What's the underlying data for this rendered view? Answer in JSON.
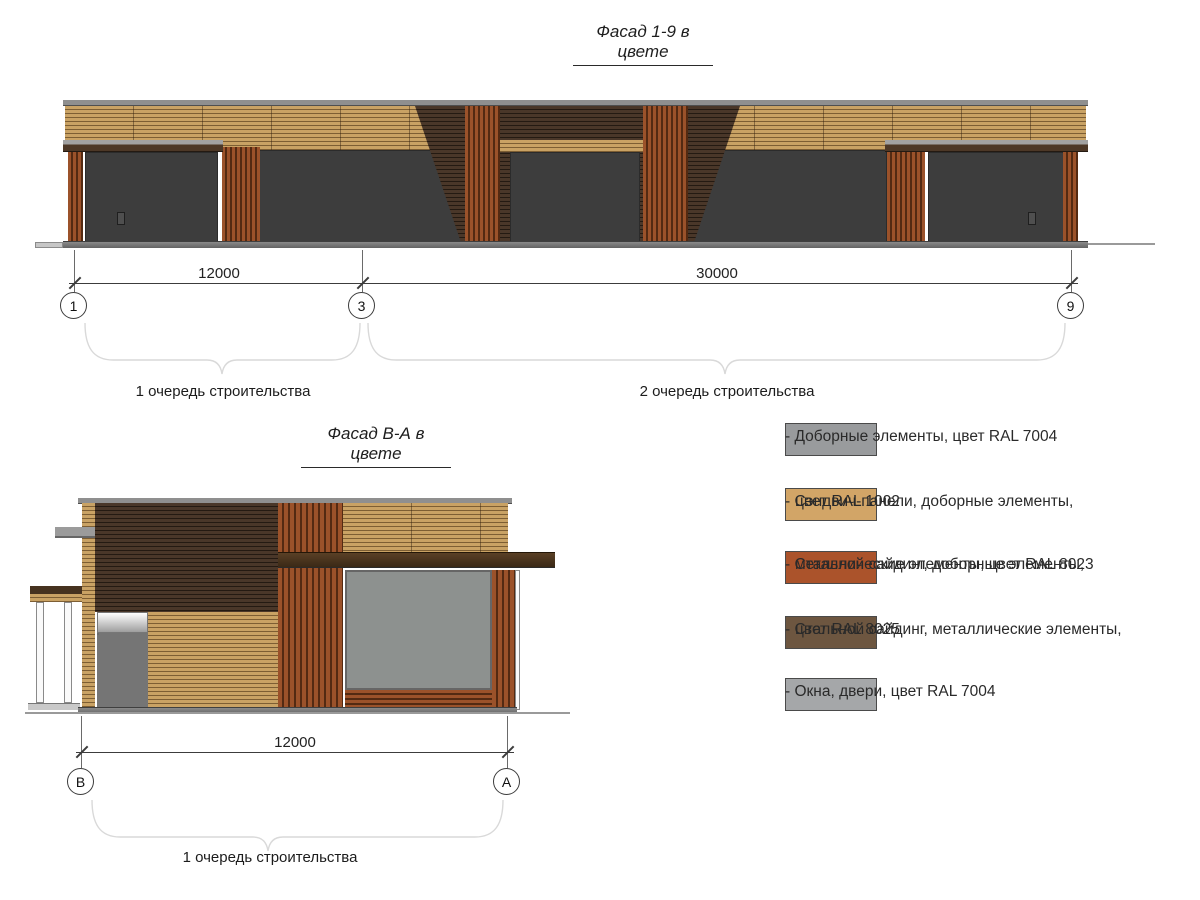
{
  "palette": {
    "tan": "#c9a264",
    "tan_dark": "#7d5e33",
    "brown": "#4a3729",
    "brown_dark": "#241a12",
    "red": "#9b522a",
    "red_dark": "#532a12",
    "cap_gray": "#8f8f8f",
    "fascia_brown": "#4d3827",
    "frame_dark": "#3d3d3d",
    "frame_gray": "#8d918f"
  },
  "facade1": {
    "title": "Фасад 1-9 в цвете",
    "dim_left": "12000",
    "dim_right": "30000",
    "grid_marks": [
      "1",
      "3",
      "9"
    ],
    "phase1": "1 очередь строительства",
    "phase2": "2 очередь строительства"
  },
  "facade2": {
    "title": "Фасад В-А в цвете",
    "dim": "12000",
    "grid_marks": [
      "В",
      "А"
    ],
    "phase1": "1 очередь строительства"
  },
  "legend": {
    "items": [
      {
        "color": "#999b9d",
        "lines": [
          "- Доборные элементы, цвет RAL 7004",
          ""
        ]
      },
      {
        "color": "#d2a567",
        "lines": [
          "- Сэндвич-панели, доборные элементы,",
          "цвет RAL 1002"
        ]
      },
      {
        "color": "#ab532b",
        "lines": [
          "- Стальной сайдинг, доборные элементы,",
          "металлические элементы, цвет RAL 8023"
        ]
      },
      {
        "color": "#6d5640",
        "lines": [
          "- Стальной сайдинг, металлические элементы,",
          "цвет RAL 8025"
        ]
      },
      {
        "color": "#a5a7a9",
        "lines": [
          "- Окна, двери, цвет RAL 7004",
          ""
        ]
      }
    ]
  }
}
